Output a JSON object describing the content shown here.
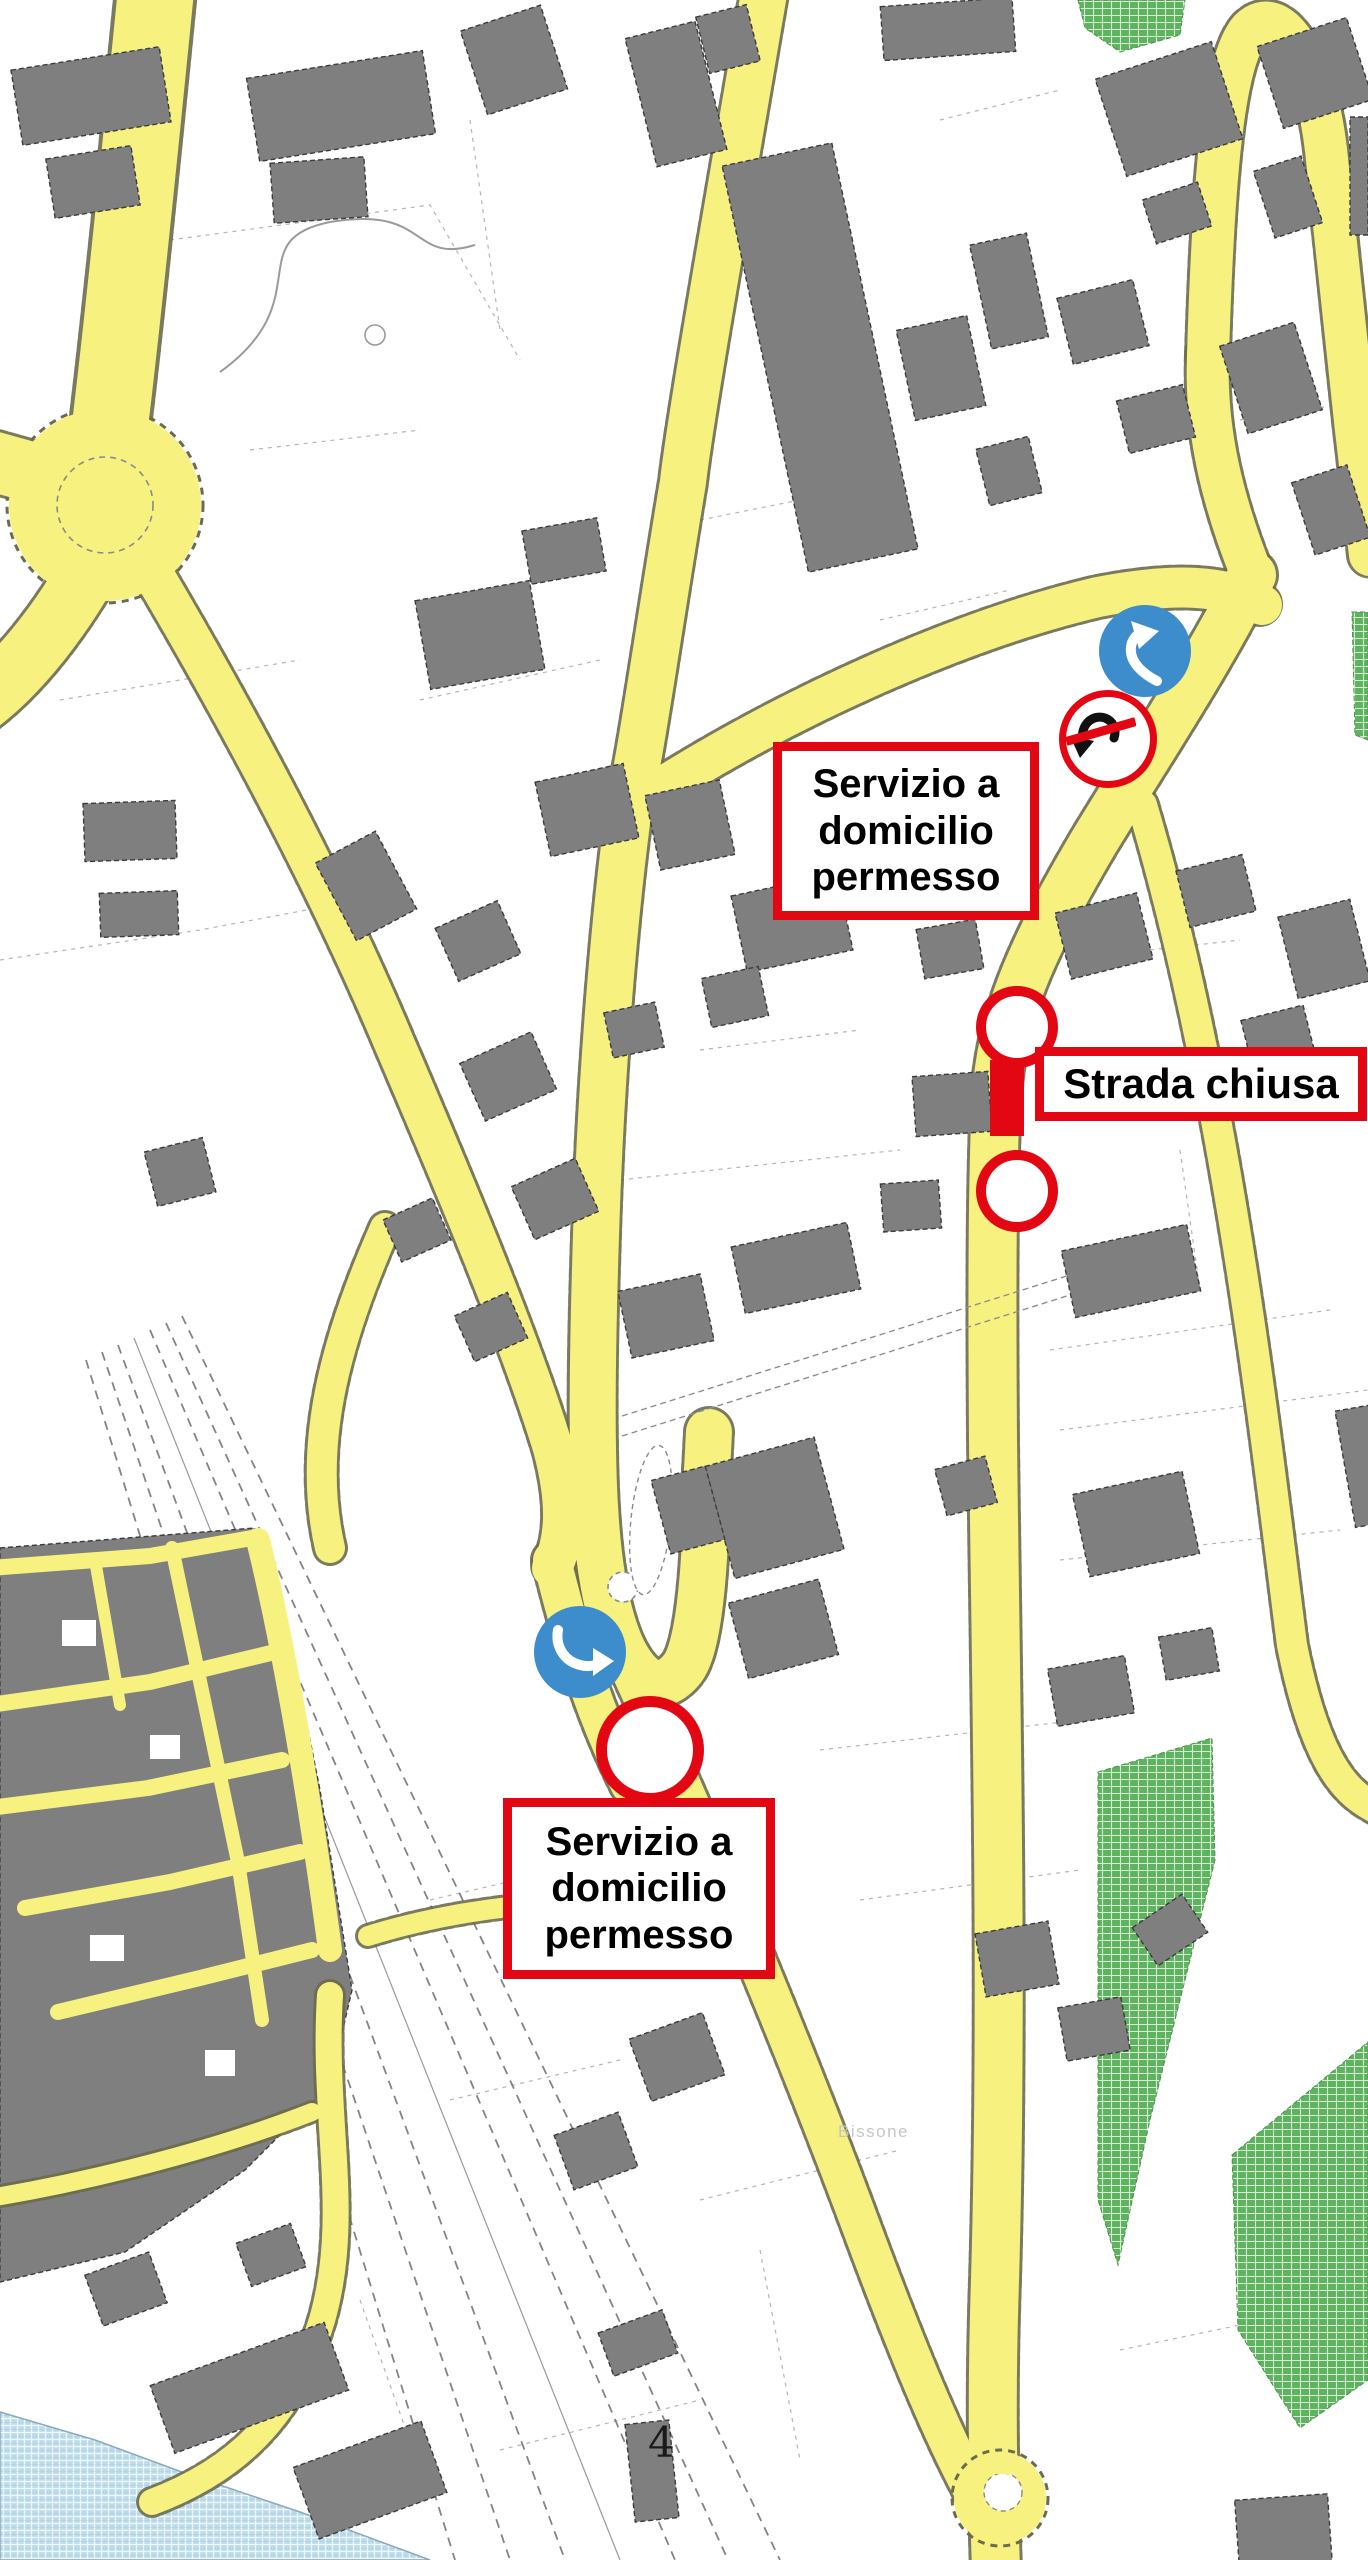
{
  "map": {
    "type": "traffic-restriction-plan",
    "labels": {
      "place_faint": "Bissone",
      "sheet_number": "4"
    },
    "annotations": {
      "service_top": {
        "text": "Servizio a domicilio permesso"
      },
      "service_bottom": {
        "text": "Servizio a domicilio permesso"
      },
      "road_closed": {
        "text": "Strada chiusa"
      }
    },
    "signs": [
      {
        "name": "mandatory-turn-left",
        "shape": "blue-circle-white-curved-arrow"
      },
      {
        "name": "no-u-turn",
        "shape": "red-ring-black-uturn-arrow-red-slash"
      },
      {
        "name": "mandatory-turn-right",
        "shape": "blue-circle-white-curved-arrow"
      },
      {
        "name": "closure-ring-north",
        "shape": "red-ring"
      },
      {
        "name": "closure-ring-south",
        "shape": "red-ring"
      },
      {
        "name": "closure-ring-station",
        "shape": "red-ring"
      },
      {
        "name": "closure-bar",
        "shape": "red-bar"
      }
    ],
    "colors": {
      "road": "#f7f17f",
      "road-edge": "#6b6b4f",
      "building": "#7f7f7f",
      "outline": "#3c3c3c",
      "red": "#e30613",
      "sign-blue": "#3d8dcc",
      "green": "#5eb35e",
      "water": "#bcdcec",
      "parcel": "#b5b5b5"
    }
  }
}
